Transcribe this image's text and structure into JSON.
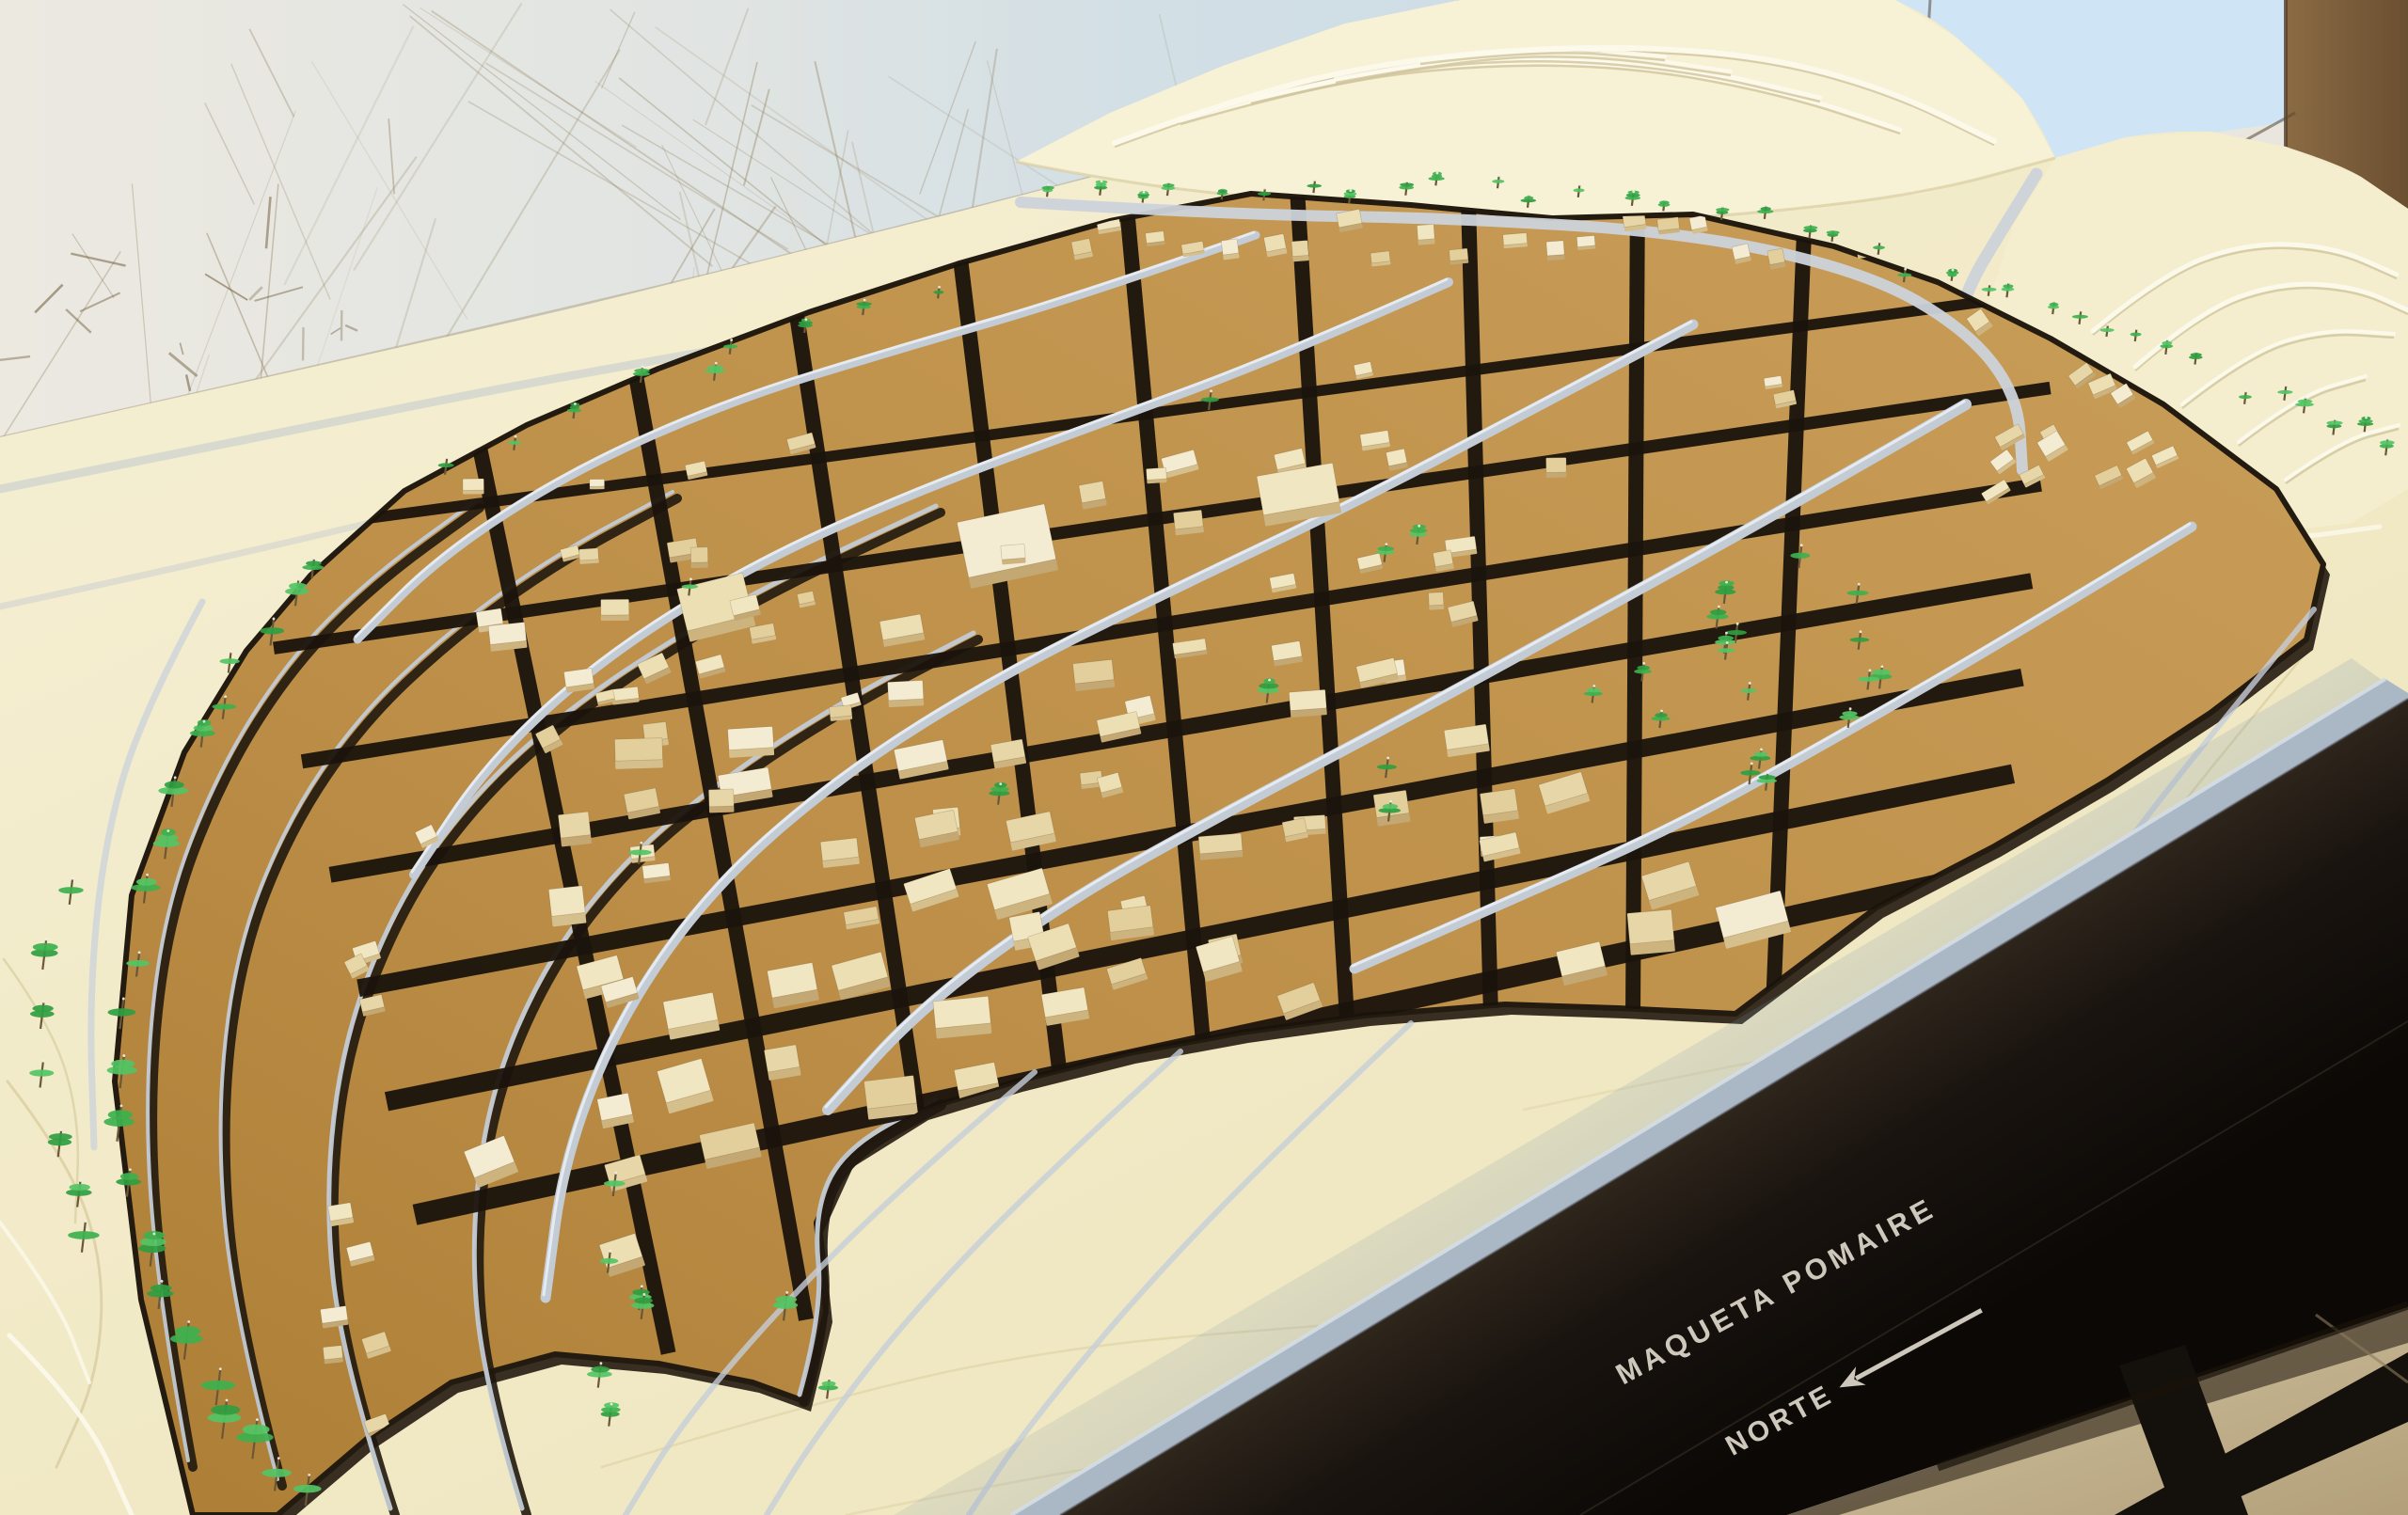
{
  "photo": {
    "description": "Photograph of a physical architectural scale model (topographic maqueta) of the town of Pomaire: cream contour terrain, kraft-brown town terraces with small wooden buildings, black streets, silver streams and green pin trees, mounted on a black table with an engraved label.",
    "title_label": "MAQUETA POMAIRE",
    "north_label": "NORTE",
    "north_arrow_glyph": "←"
  },
  "palette": {
    "wall_left": "#ece9e1",
    "wall_right": "#cfdde6",
    "sky": "#cfe5f5",
    "door_brown": "#7e603c",
    "terrain_cream": "#f2ebca",
    "terrain_light": "#f7f1d6",
    "contour_line": "#d9cda0",
    "contour_highlight": "#fcf9ec",
    "town_brown": "#bd8f49",
    "town_brown_light": "#c99e58",
    "town_shadow": "#231a10",
    "road_black": "#1b140c",
    "stream_silver": "#c3cbd5",
    "stream_highlight": "#e9eef4",
    "ridge_road": "#ccd3da",
    "building_top": "#eee2ba",
    "building_side": "#d0b885",
    "tree_green": "#3fb152",
    "tree_stem": "#6a5837",
    "base_edge_blue": "#a9b8c4",
    "band_black": "#14100a",
    "band_text": "#d8d2c6",
    "backdrop_beige": "#c6b593",
    "leg_black": "#14100b",
    "scratch": "#8f7d5b"
  }
}
